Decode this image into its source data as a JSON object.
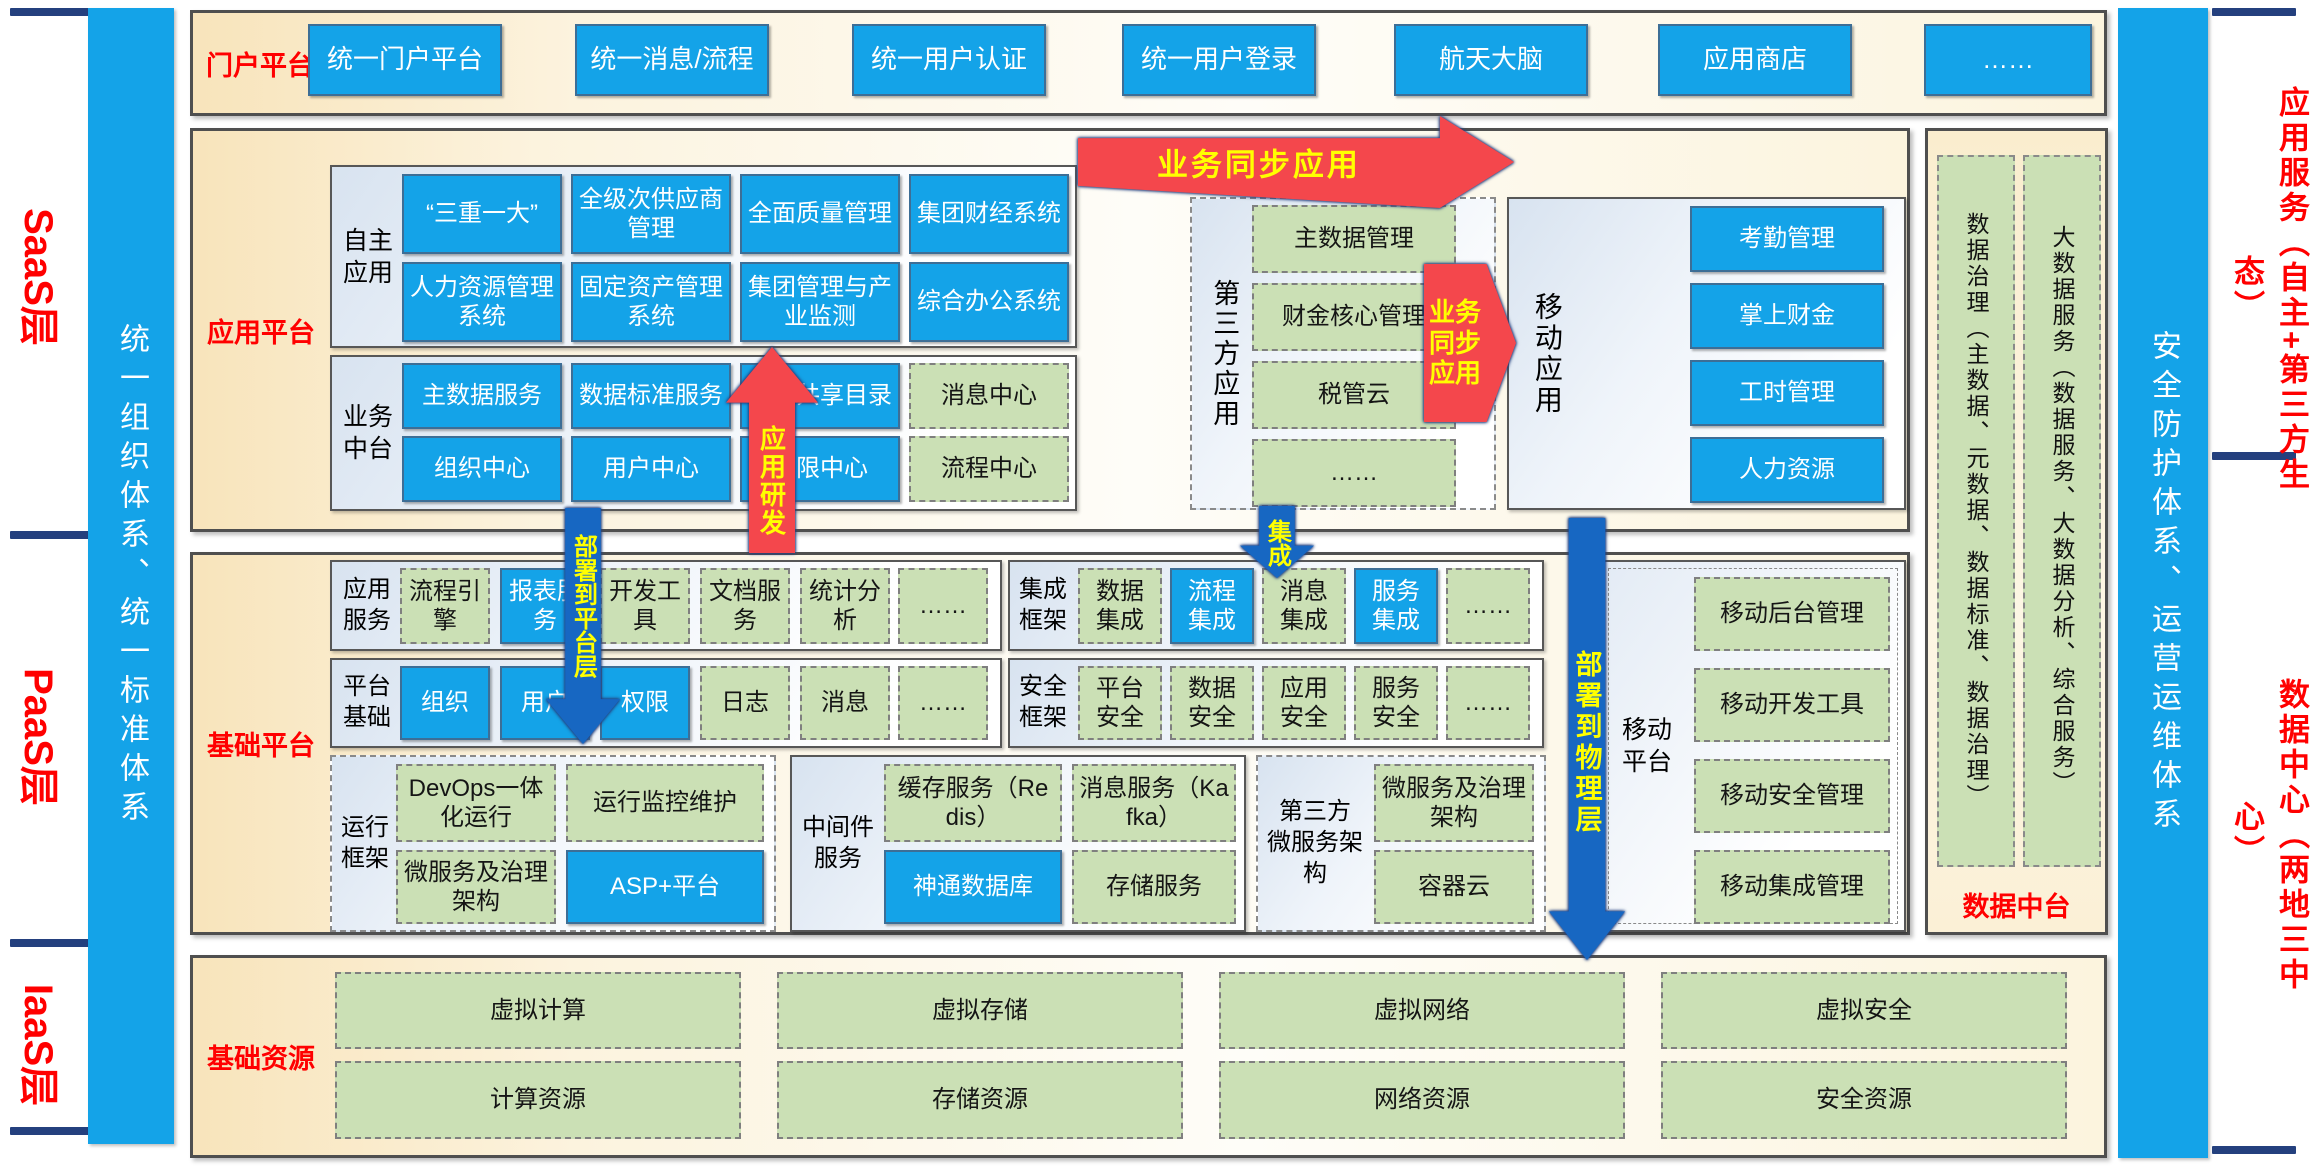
{
  "colors": {
    "accent_blue": "#14A3E8",
    "chip_green": "#CBE0B5",
    "arrow_red": "#F4474C",
    "arrow_blue": "#1767C2",
    "navy": "#24407E",
    "label_red": "#FF0000",
    "arrow_text_yellow": "#FFFF00",
    "section_cream": "#F8E4BB"
  },
  "layers": {
    "saas": "SaaS层",
    "paas": "PaaS层",
    "iaas": "IaaS层"
  },
  "pillars": {
    "left": "统一组织体系、统一标准体系",
    "right": "安全防护体系、运营运维体系"
  },
  "right_labels": {
    "top": "应用服务（自主+第三方生态）",
    "bottom": "数据中心（两地三中心）"
  },
  "portal": {
    "label": "门户平台",
    "buttons": [
      "统一门户平台",
      "统一消息/流程",
      "统一用户认证",
      "统一用户登录",
      "航天大脑",
      "应用商店",
      "……"
    ]
  },
  "app_platform": {
    "label": "应用平台",
    "self_apps": {
      "label": "自主应用",
      "rows": [
        [
          "“三重一大”",
          "全级次供应商管理",
          "全面质量管理",
          "集团财经系统"
        ],
        [
          "人力资源管理系统",
          "固定资产管理系统",
          "集团管理与产业监测",
          "综合办公系统"
        ]
      ]
    },
    "biz_center": {
      "label": "业务中台",
      "rows": [
        [
          "主数据服务",
          "数据标准服务",
          "数据共享目录",
          "消息中心"
        ],
        [
          "组织中心",
          "用户中心",
          "权限中心",
          "流程中心"
        ]
      ]
    },
    "third_party": {
      "label": "第三方应用",
      "items": [
        "主数据管理",
        "财金核心管理",
        "税管云",
        "……"
      ]
    },
    "mobile_apps": {
      "label": "移动应用",
      "items": [
        "考勤管理",
        "掌上财金",
        "工时管理",
        "人力资源"
      ]
    }
  },
  "arrows": {
    "biz_sync_top": "业务同步应用",
    "biz_sync_right": "业务同步应用",
    "app_dev": "应用研发",
    "integrate": "集成",
    "deploy_platform": "部署到平台层",
    "deploy_physical": "部署到物理层"
  },
  "base_platform": {
    "label": "基础平台",
    "app_services": {
      "label": "应用服务",
      "items": [
        "流程引擎",
        "报表服务",
        "开发工具",
        "文档服务",
        "统计分析",
        "……"
      ]
    },
    "platform_base": {
      "label": "平台基础",
      "items": [
        "组织",
        "用户",
        "权限",
        "日志",
        "消息",
        "……"
      ]
    },
    "runtime": {
      "label": "运行框架",
      "items": [
        "DevOps一体化运行",
        "运行监控维护",
        "微服务及治理架构",
        "ASP+平台"
      ]
    },
    "middleware": {
      "label": "中间件服务",
      "items": [
        "缓存服务（Redis）",
        "消息服务（Kafka）",
        "神通数据库",
        "存储服务"
      ]
    },
    "integration": {
      "label": "集成框架",
      "items": [
        "数据集成",
        "流程集成",
        "消息集成",
        "服务集成",
        "……"
      ]
    },
    "security": {
      "label": "安全框架",
      "items": [
        "平台安全",
        "数据安全",
        "应用安全",
        "服务安全",
        "……"
      ]
    },
    "third_ms": {
      "label_lines": [
        "第三方",
        "微服务架构"
      ],
      "items": [
        "微服务及治理架构",
        "容器云"
      ]
    },
    "mobile_platform": {
      "label": "移动平台",
      "items": [
        "移动后台管理",
        "移动开发工具",
        "移动安全管理",
        "移动集成管理"
      ]
    }
  },
  "data_panel": {
    "col1": "数据治理（主数据、元数据、数据标准、数据治理）",
    "col2": "大数据服务（数据服务、大数据分析、综合服务）",
    "footer": "数据中台"
  },
  "base_resources": {
    "label": "基础资源",
    "rows": [
      [
        "虚拟计算",
        "虚拟存储",
        "虚拟网络",
        "虚拟安全"
      ],
      [
        "计算资源",
        "存储资源",
        "网络资源",
        "安全资源"
      ]
    ]
  }
}
